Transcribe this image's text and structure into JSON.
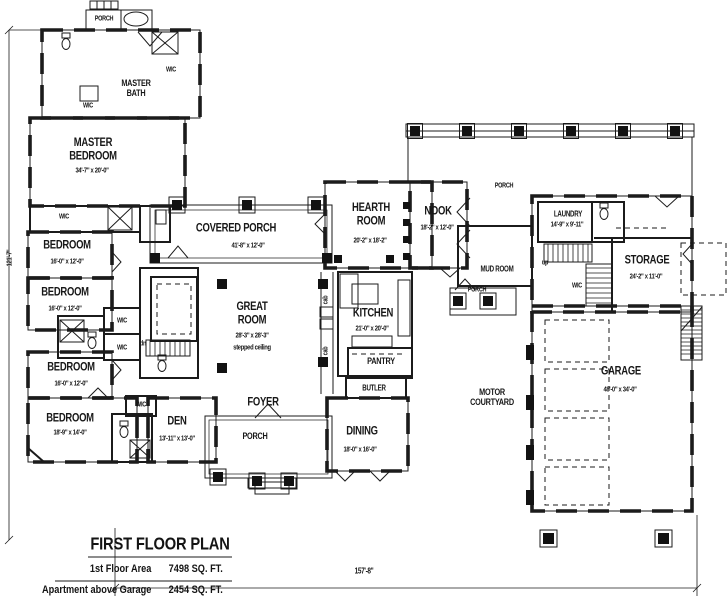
{
  "plan": {
    "rooms": {
      "master_bedroom": {
        "name": "MASTER\nBEDROOM",
        "dims": "34'-7\" x 20'-0\""
      },
      "master_bath": {
        "name": "MASTER\nBATH"
      },
      "bedroom_top": {
        "name": "BEDROOM",
        "dims": "16'-0\" x 12'-0\""
      },
      "bedroom_mid": {
        "name": "BEDROOM",
        "dims": "16'-0\" x 12'-0\""
      },
      "bedroom_lower": {
        "name": "BEDROOM",
        "dims": "16'-0\" x 12'-0\""
      },
      "bedroom_bottom": {
        "name": "BEDROOM",
        "dims": "18'-9\" x 14'-0\""
      },
      "den": {
        "name": "DEN",
        "dims": "13'-11\" x 13'-0\""
      },
      "covered_porch": {
        "name": "COVERED PORCH",
        "dims": "41'-8\" x 12'-0\""
      },
      "great_room": {
        "name": "GREAT\nROOM",
        "dims": "28'-3\" x 28'-3\"",
        "note": "stepped ceiling"
      },
      "hearth_room": {
        "name": "HEARTH\nROOM",
        "dims": "20'-2\" x 18'-2\""
      },
      "nook": {
        "name": "NOOK",
        "dims": "18'-2\" x 12'-0\""
      },
      "kitchen": {
        "name": "KITCHEN",
        "dims": "21'-0\" x 20'-0\""
      },
      "pantry": {
        "name": "PANTRY"
      },
      "butler": {
        "name": "BUTLER"
      },
      "foyer": {
        "name": "FOYER"
      },
      "dining": {
        "name": "DINING",
        "dims": "18'-0\" x 16'-0\""
      },
      "mud_room": {
        "name": "MUD ROOM"
      },
      "laundry": {
        "name": "LAUNDRY",
        "dims": "14'-9\" x 9'-11\""
      },
      "storage": {
        "name": "STORAGE",
        "dims": "24'-2\" x 11'-0\""
      },
      "garage": {
        "name": "GARAGE",
        "dims": "48'-0\" x 34'-0\""
      },
      "motor_courtyard": {
        "name": "MOTOR\nCOURTYARD"
      }
    },
    "small_labels": {
      "porch": "PORCH",
      "wic": "WIC",
      "dn": "dn",
      "up": "up",
      "cab": "cab"
    },
    "dimensions": {
      "overall_width": "157'-8\"",
      "overall_height": "121'-7\""
    },
    "title_block": {
      "title": "FIRST FLOOR PLAN",
      "rows": [
        {
          "label": "1st Floor Area",
          "value": "7498 SQ. FT."
        },
        {
          "label": "Apartment above Garage",
          "value": "2454 SQ. FT."
        }
      ]
    },
    "colors": {
      "ink": "#1b1b1b",
      "paper": "#ffffff"
    }
  }
}
